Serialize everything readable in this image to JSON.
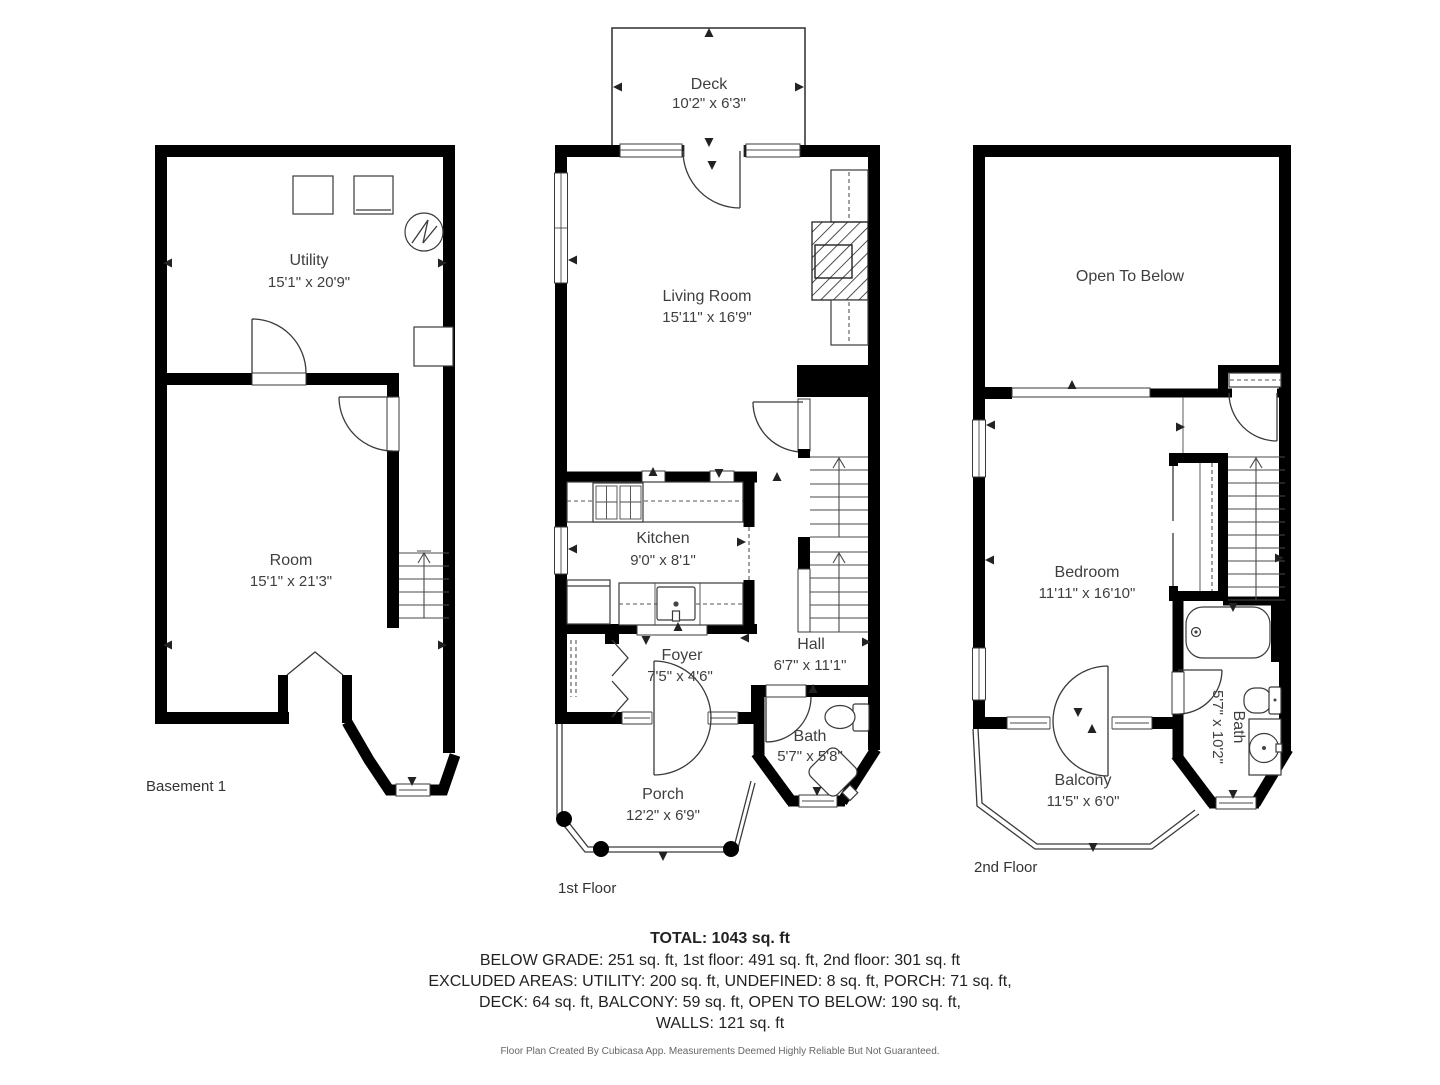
{
  "page": {
    "background": "#ffffff",
    "wall_color": "#000000",
    "line_color": "#3a3a3a",
    "text_color": "#3f3f3f"
  },
  "floors": {
    "basement": {
      "label": "Basement 1",
      "rooms": {
        "utility": {
          "name": "Utility",
          "dims": "15'1\" x 20'9\""
        },
        "room": {
          "name": "Room",
          "dims": "15'1\" x 21'3\""
        }
      }
    },
    "first": {
      "label": "1st Floor",
      "rooms": {
        "deck": {
          "name": "Deck",
          "dims": "10'2\" x 6'3\""
        },
        "living_room": {
          "name": "Living Room",
          "dims": "15'11\" x 16'9\""
        },
        "kitchen": {
          "name": "Kitchen",
          "dims": "9'0\" x 8'1\""
        },
        "foyer": {
          "name": "Foyer",
          "dims": "7'5\" x 4'6\""
        },
        "hall": {
          "name": "Hall",
          "dims": "6'7\" x 11'1\""
        },
        "bath": {
          "name": "Bath",
          "dims": "5'7\" x 5'8\""
        },
        "porch": {
          "name": "Porch",
          "dims": "12'2\" x 6'9\""
        }
      }
    },
    "second": {
      "label": "2nd Floor",
      "rooms": {
        "open_to_below": {
          "name": "Open To Below"
        },
        "bedroom": {
          "name": "Bedroom",
          "dims": "11'11\" x 16'10\""
        },
        "bath": {
          "name": "Bath",
          "dims": "5'7\" x 10'2\""
        },
        "balcony": {
          "name": "Balcony",
          "dims": "11'5\" x 6'0\""
        }
      }
    }
  },
  "summary": {
    "total": "TOTAL: 1043 sq. ft",
    "by_floor": "BELOW GRADE: 251 sq. ft, 1st floor: 491 sq. ft, 2nd floor: 301 sq. ft",
    "excluded_line_1": "EXCLUDED AREAS: UTILITY: 200 sq. ft, UNDEFINED: 8 sq. ft, PORCH: 71 sq. ft,",
    "excluded_line_2": "DECK: 64 sq. ft, BALCONY: 59 sq. ft, OPEN TO BELOW: 190 sq. ft,",
    "excluded_line_3": "WALLS: 121 sq. ft"
  },
  "footer": {
    "disclaimer": "Floor Plan Created By Cubicasa App. Measurements Deemed Highly Reliable But Not Guaranteed."
  }
}
